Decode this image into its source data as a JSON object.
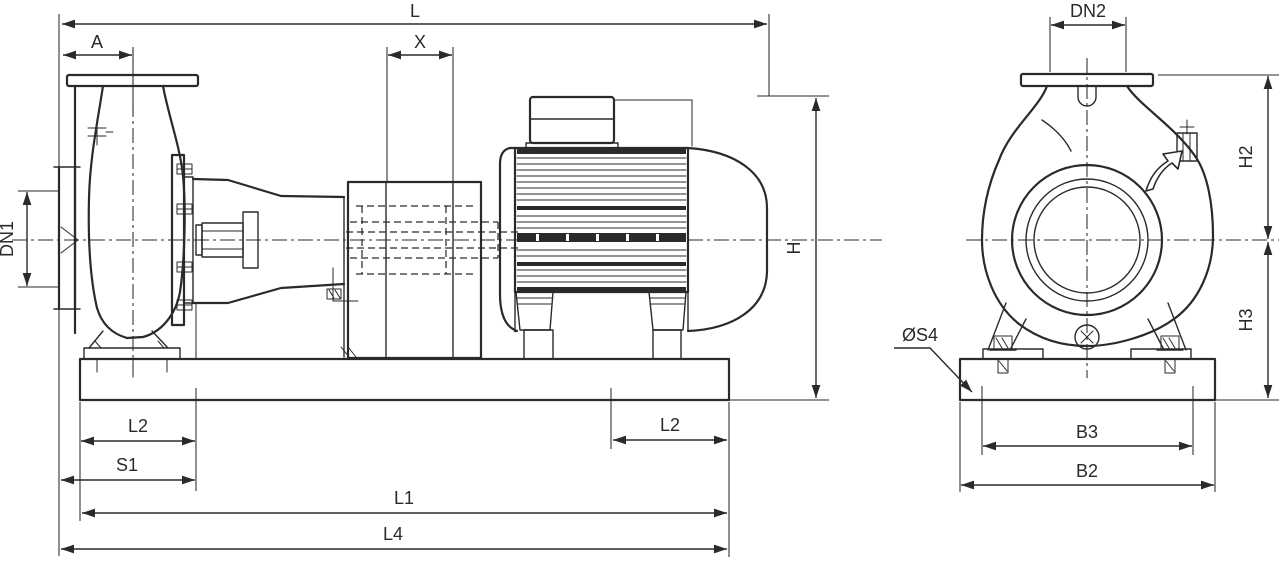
{
  "meta": {
    "drawing_type": "pump dimensional drawing",
    "background": "#ffffff",
    "line_color": "#2b2a29",
    "text_color": "#2b2a29"
  },
  "views": {
    "side": {
      "title": "side view",
      "dims": {
        "L": "L",
        "A": "A",
        "X": "X",
        "DN1": "DN1",
        "H": "H",
        "L2_left": "L2",
        "S1": "S1",
        "L1": "L1",
        "L4": "L4",
        "L2_right": "L2"
      }
    },
    "end": {
      "title": "end view",
      "dims": {
        "DN2": "DN2",
        "H2": "H2",
        "H3": "H3",
        "S4": "ØS4",
        "B3": "B3",
        "B2": "B2"
      }
    }
  }
}
